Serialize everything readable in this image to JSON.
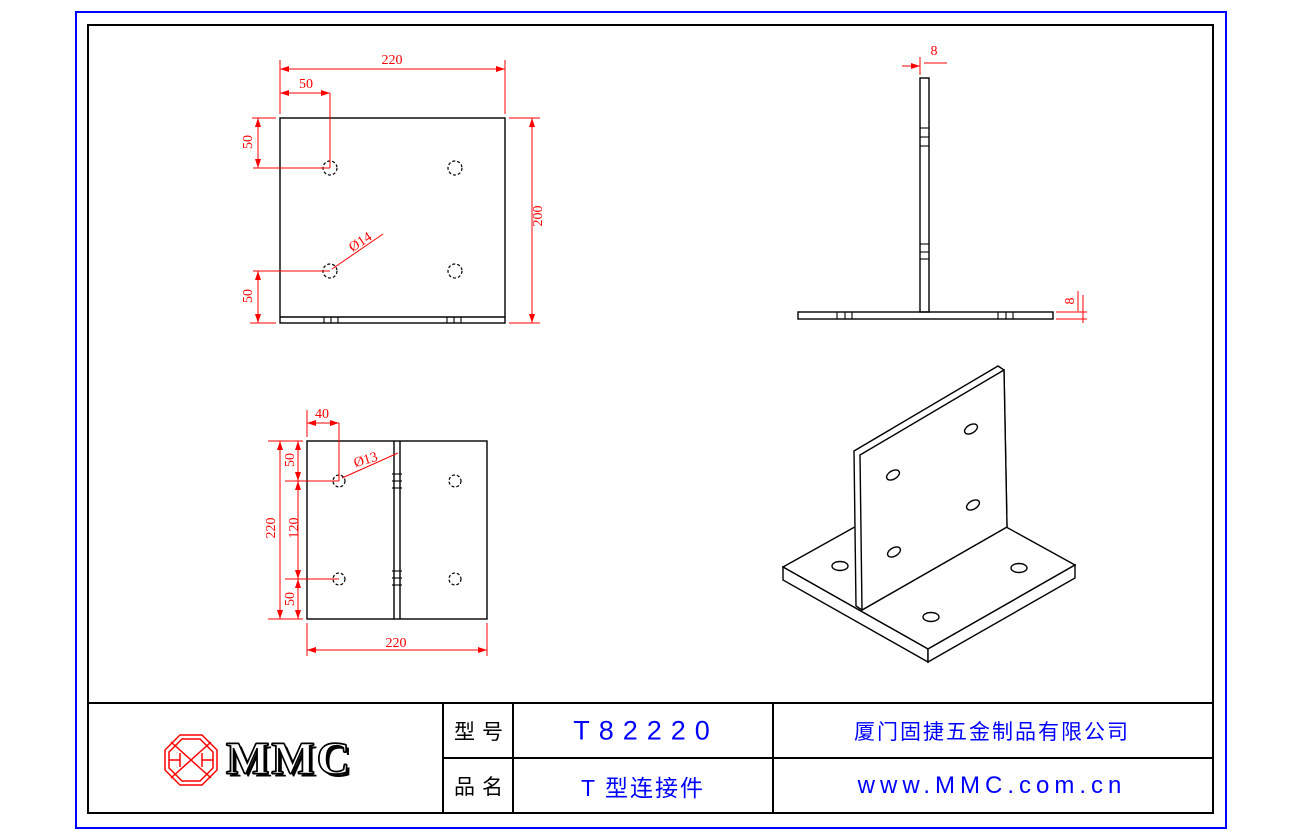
{
  "drawing": {
    "front_view": {
      "dim_width_top": "220",
      "dim_offset_top": "50",
      "dim_left_top": "50",
      "dim_left_bottom": "50",
      "dim_height_right": "200",
      "dim_hole_dia": "Ø14"
    },
    "side_view": {
      "dim_web_thickness": "8",
      "dim_base_thickness": "8"
    },
    "top_view": {
      "dim_offset_top": "40",
      "dim_height_left": "220",
      "dim_seg_top": "50",
      "dim_seg_mid": "120",
      "dim_seg_bottom": "50",
      "dim_width_bottom": "220",
      "dim_hole_dia": "Ø13"
    }
  },
  "title_block": {
    "logo_text": "MMC",
    "model_label": "型号",
    "model_value": "T82220",
    "name_label": "品名",
    "name_value": "T 型连接件",
    "company": "厦门固捷五金制品有限公司",
    "website": "www.MMC.com.cn"
  },
  "colors": {
    "dimension": "#ff0000",
    "outline": "#000000",
    "border_outer": "#0000ff",
    "title_text": "#0000ff",
    "logo_red": "#ff0000"
  }
}
